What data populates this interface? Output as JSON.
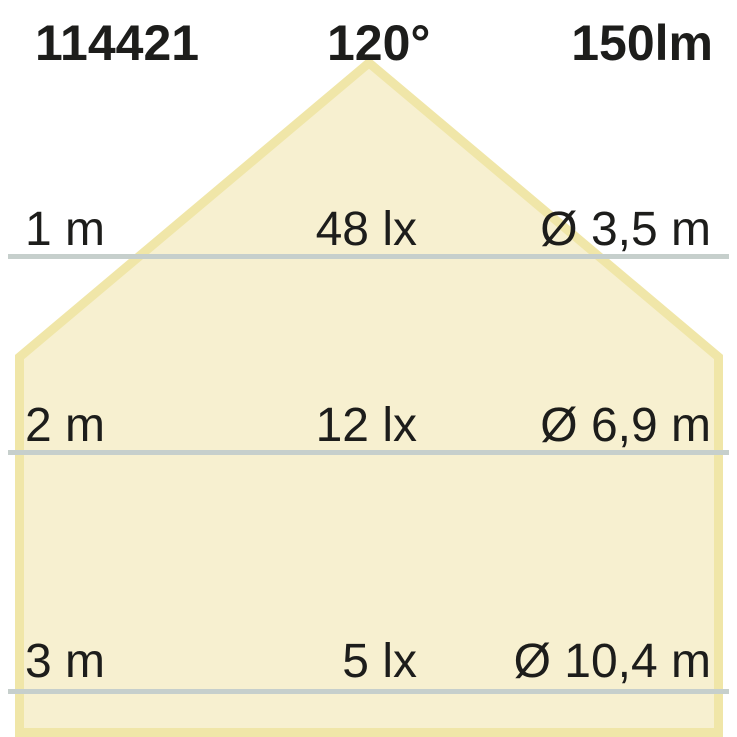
{
  "header": {
    "article_number": "114421",
    "beam_angle": "120°",
    "luminous_flux": "150lm"
  },
  "rows": [
    {
      "distance": "1 m",
      "illuminance": "48 lx",
      "diameter": "Ø 3,5 m"
    },
    {
      "distance": "2 m",
      "illuminance": "12 lx",
      "diameter": "Ø 6,9 m"
    },
    {
      "distance": "3 m",
      "illuminance": "5 lx",
      "diameter": "Ø 10,4 m"
    }
  ],
  "colors": {
    "cone_fill": "#f7f0d0",
    "cone_edge_band": "#f0e6a8",
    "separator_line": "#c6cfcc",
    "text": "#1d1d1b",
    "background": "#ffffff"
  }
}
